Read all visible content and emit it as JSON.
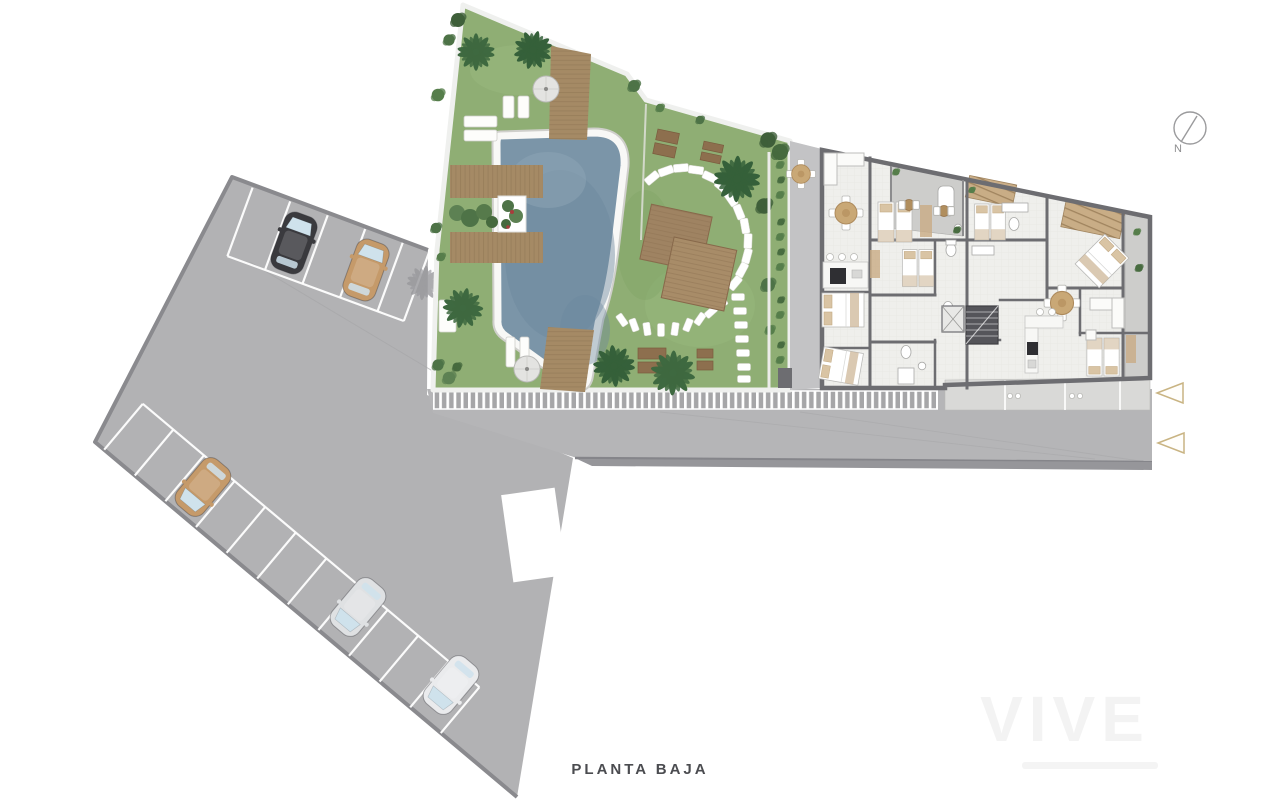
{
  "page": {
    "background": "#ffffff",
    "title_label": "PLANTA BAJA"
  },
  "compass": {
    "label": "N"
  },
  "watermark": {
    "brand": "VIVE"
  },
  "palette": {
    "asphalt": "#b2b2b4",
    "plaza": "#b5b5b7",
    "curb": "#8a8a8e",
    "walkway_base": "#a6a6a8",
    "grass": "#8fae74",
    "grass_dark": "#6f9655",
    "water": "#7b95a8",
    "coping": "#f8f8f6",
    "deck": "#a58a65",
    "deck_line": "#8f7454",
    "floor": "#efefec",
    "wall": "#6d6d71",
    "terrace": "#cdcdcb",
    "pergola": "#c6a87e",
    "triangle": "#c9b483",
    "compass_gray": "#9a9a9c"
  },
  "parking": {
    "top_row_cars": 2,
    "bottom_row_cars": 3,
    "cars": [
      {
        "row": "top",
        "color": "#3a3a3e"
      },
      {
        "row": "top",
        "color": "#c59a6a"
      },
      {
        "row": "bottom",
        "color": "#c59a6a"
      },
      {
        "row": "bottom",
        "color": "#dfe1e3"
      },
      {
        "row": "bottom",
        "color": "#eaebed"
      }
    ]
  },
  "markers": {
    "direction_triangles": 2
  }
}
